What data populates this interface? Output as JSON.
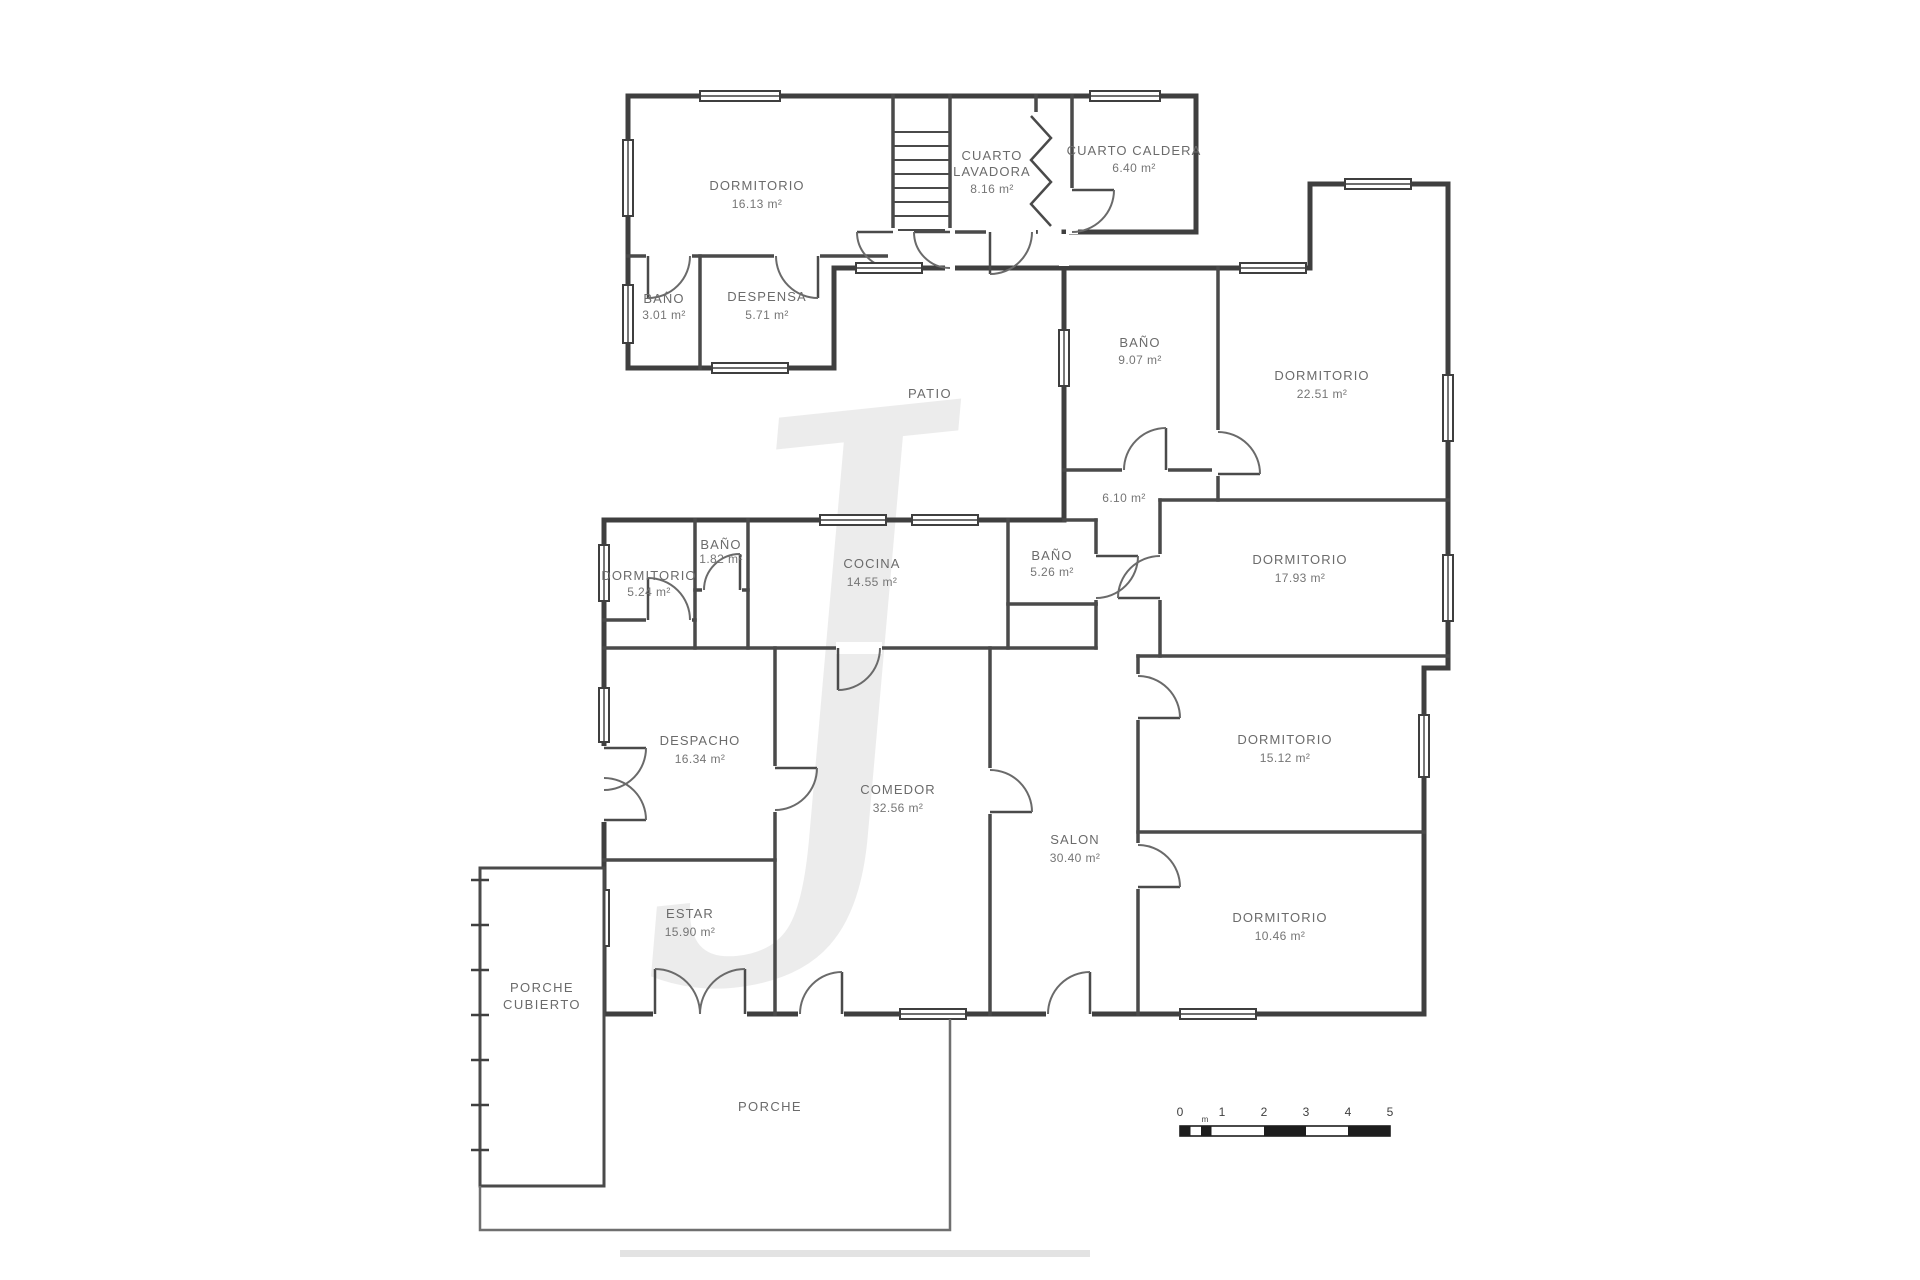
{
  "watermark": "J",
  "zones": {
    "patio": "PATIO",
    "porch_covered_line1": "PORCHE",
    "porch_covered_line2": "CUBIERTO",
    "porch": "PORCHE",
    "hall_area": "6.10 m²"
  },
  "rooms": [
    {
      "name": "DORMITORIO",
      "area": "16.13 m²"
    },
    {
      "name": "CUARTO",
      "name2": "LAVADORA",
      "area": "8.16 m²"
    },
    {
      "name": "CUARTO CALDERA",
      "area": "6.40 m²"
    },
    {
      "name": "BAÑO",
      "area": "3.01 m²"
    },
    {
      "name": "DESPENSA",
      "area": "5.71 m²"
    },
    {
      "name": "BAÑO",
      "area": "9.07 m²"
    },
    {
      "name": "DORMITORIO",
      "area": "22.51 m²"
    },
    {
      "name": "DORMITORIO",
      "area": "17.93 m²"
    },
    {
      "name": "DORMITORIO",
      "area": "5.24 m²"
    },
    {
      "name": "BAÑO",
      "area": "1.82 m²"
    },
    {
      "name": "COCINA",
      "area": "14.55 m²"
    },
    {
      "name": "BAÑO",
      "area": "5.26 m²"
    },
    {
      "name": "DESPACHO",
      "area": "16.34 m²"
    },
    {
      "name": "COMEDOR",
      "area": "32.56 m²"
    },
    {
      "name": "SALON",
      "area": "30.40 m²"
    },
    {
      "name": "DORMITORIO",
      "area": "15.12 m²"
    },
    {
      "name": "ESTAR",
      "area": "15.90 m²"
    },
    {
      "name": "DORMITORIO",
      "area": "10.46 m²"
    }
  ],
  "scale_bar": {
    "ticks": [
      "0",
      "1",
      "2",
      "3",
      "4",
      "5"
    ],
    "unit": "m"
  }
}
